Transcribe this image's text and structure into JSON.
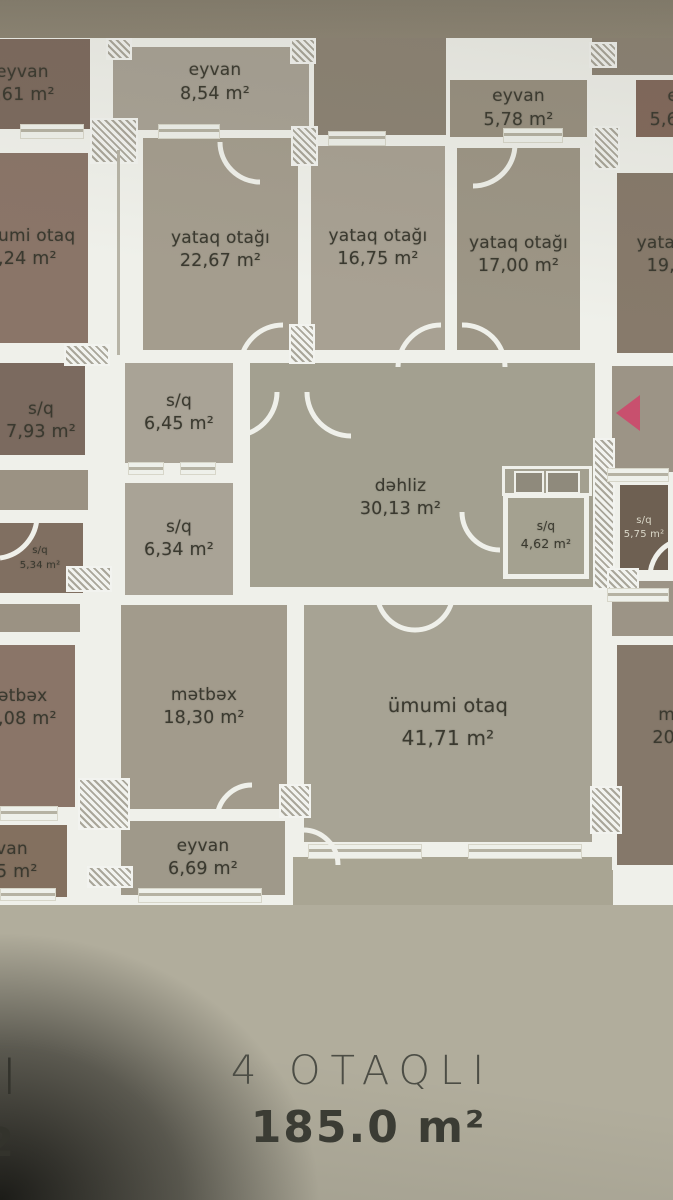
{
  "rooms": {
    "main": {
      "eyvan_top": {
        "label": "eyvan",
        "area": "8,54 m²"
      },
      "eyvan_right": {
        "label": "eyvan",
        "area": "5,78 m²"
      },
      "bedroom_1": {
        "label": "yataq otağı",
        "area": "22,67 m²"
      },
      "bedroom_2": {
        "label": "yataq otağı",
        "area": "16,75 m²"
      },
      "bedroom_3": {
        "label": "yataq otağı",
        "area": "17,00 m²"
      },
      "sq_1": {
        "label": "s/q",
        "area": "6,45 m²"
      },
      "sq_2": {
        "label": "s/q",
        "area": "6,34 m²"
      },
      "hallway": {
        "label": "dəhliz",
        "area": "30,13 m²"
      },
      "sq_3": {
        "label": "s/q",
        "area": "4,62 m²"
      },
      "kitchen": {
        "label": "mətbəx",
        "area": "18,30 m²"
      },
      "living": {
        "label": "ümumi otaq",
        "area": "41,71 m²"
      },
      "eyvan_bottom": {
        "label": "eyvan",
        "area": "6,69 m²"
      }
    },
    "left_unit": {
      "eyvan_top": {
        "label": "eyvan",
        "area": ",61 m²"
      },
      "living": {
        "label": "umi otaq",
        "area": ",24 m²"
      },
      "sq_1": {
        "label": "s/q",
        "area": "7,93 m²"
      },
      "sq_2": {
        "label": "s/q",
        "area": "5,34 m²"
      },
      "kitchen": {
        "label": "ətbəx",
        "area": ",08 m²"
      },
      "eyvan_bottom": {
        "label": "van",
        "area": "5 m²"
      }
    },
    "right_unit": {
      "eyvan_top": {
        "label": "e",
        "area": "5,6"
      },
      "bedroom": {
        "label": "yata",
        "area": "19,"
      },
      "sq": {
        "label": "s/q",
        "area": "5,75 m²"
      },
      "kitchen": {
        "label": "m",
        "area": "20"
      }
    }
  },
  "footer": {
    "title": "4 OTAQLI",
    "area": "185.0 m²"
  },
  "edge_fragments": {
    "top": "I",
    "bottom": "2"
  },
  "palette": {
    "paper": "#b1ad9c",
    "paper_dark": "#8b8272",
    "wall_white": "#eff0ea",
    "text_dark": "#3a392f",
    "marker_red": "#c8506e",
    "room_gray": "#a8a295",
    "room_brown": "#8a7568"
  }
}
